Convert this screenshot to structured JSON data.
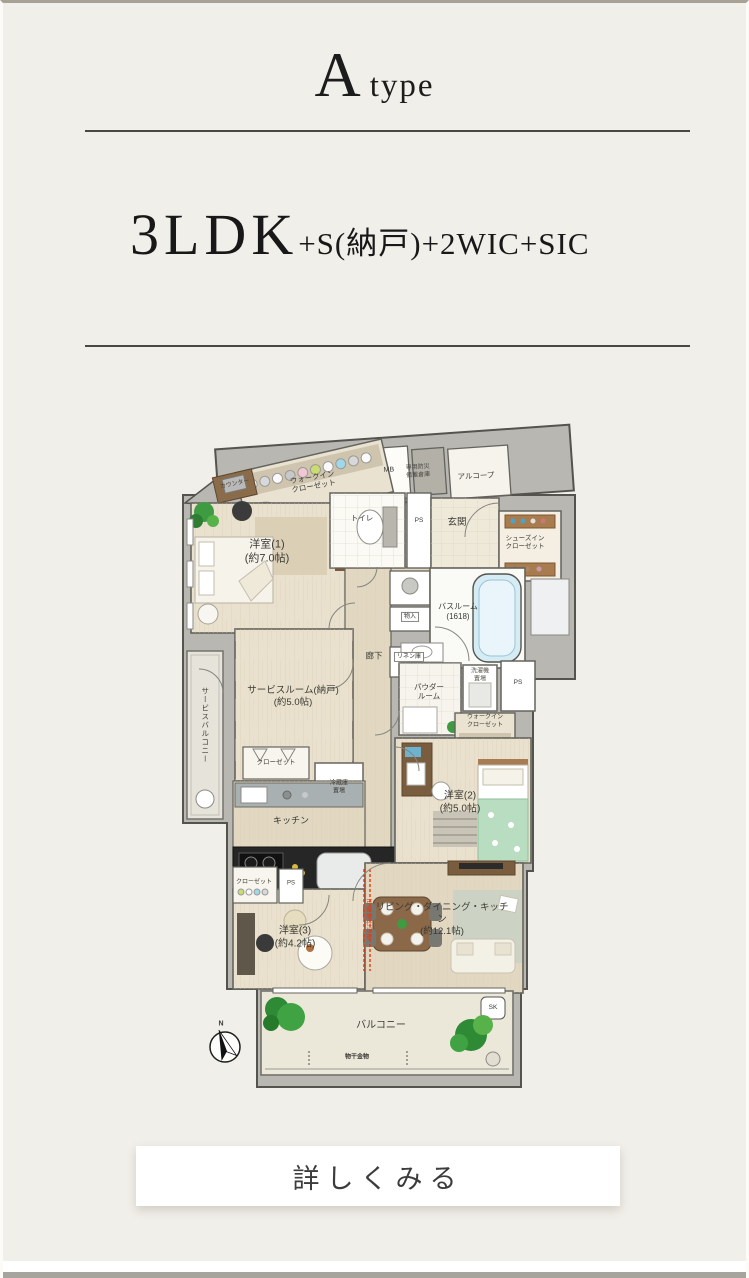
{
  "header": {
    "title_big": "A",
    "title_small": "type"
  },
  "spec": {
    "main": "3LDK",
    "suffix": "+S(納戸)+2WIC+SIC"
  },
  "cta": {
    "label": "詳しくみる"
  },
  "plan": {
    "walk_in_closet_1": "ウォークイン\nクローゼット",
    "counter": "カウンター",
    "mb": "MB",
    "disaster_storage": "専用防災\n備蓄倉庫",
    "alcove": "アルコープ",
    "toilet": "トイレ",
    "ps_1": "PS",
    "entrance": "玄関",
    "shoes_in_closet": "シューズイン\nクローゼット",
    "western_room_1": "洋室(1)\n(約7.0帖)",
    "storage": "物入",
    "linen_storage": "リネン庫",
    "bathroom": "バスルーム\n(1618)",
    "hallway": "廊下",
    "service_room": "サービスルーム(納戸)\n(約5.0帖)",
    "powder_room": "パウダー\nルーム",
    "washer_place": "洗濯機\n置場",
    "ps_2": "PS",
    "walk_in_closet_2": "ウォークイン\nクローゼット",
    "service_balcony": "サービスバルコニー",
    "closet_1": "クローゼット",
    "fridge_place": "冷蔵庫\n置場",
    "kitchen": "キッチン",
    "western_room_2": "洋室(2)\n(約5.0帖)",
    "closet_2": "クローゼット",
    "ps_3": "PS",
    "western_room_3": "洋室(3)\n(約4.2帖)",
    "movable_partition": "可動間仕切壁",
    "ldk": "リビング・ダイニング・キッチン\n(約12.1帖)",
    "balcony": "バルコニー",
    "sk": "SK",
    "laundry_hardware": "物干金物",
    "compass_north": "N"
  },
  "colors": {
    "page_bg": "#f1efe9",
    "structure_gray": "#b9b7b2",
    "accent_red": "#e8380d",
    "tub_blue": "#d5ecf5"
  }
}
